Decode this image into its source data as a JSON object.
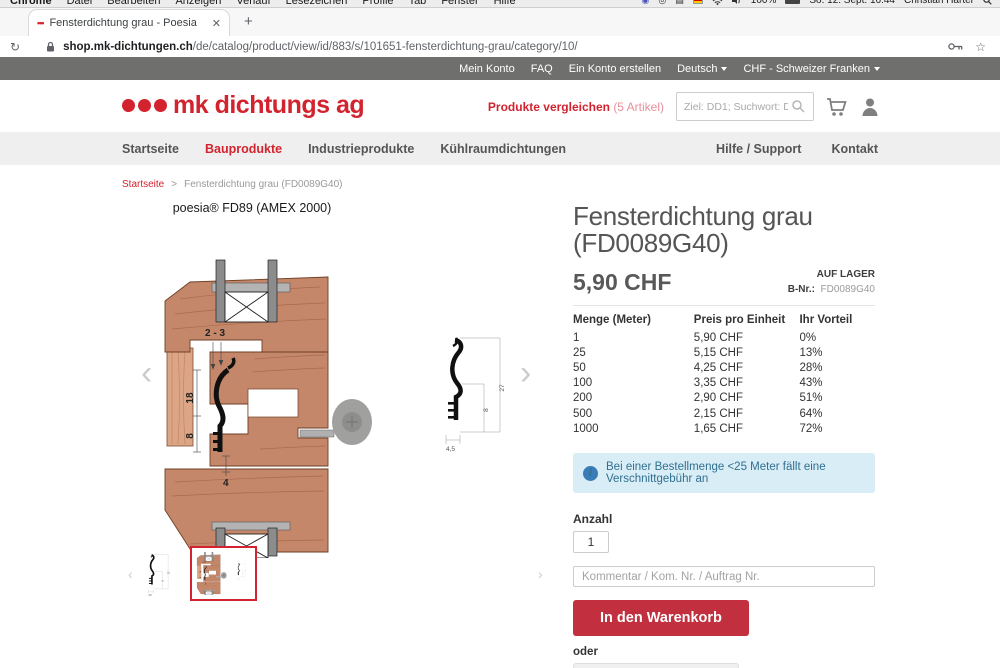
{
  "colors": {
    "brand_red": "#d2232f",
    "button_red": "#c22f3e",
    "topbar_gray": "#6f6f6e",
    "nav_bg": "#f0efef",
    "info_bg": "#d9edf7",
    "info_text": "#31708f",
    "wood": "#c5876a"
  },
  "macos_menubar": {
    "apps": [
      "Chrome",
      "Datei",
      "Bearbeiten",
      "Anzeigen",
      "Verlauf",
      "Lesezeichen",
      "Profile",
      "Tab",
      "Fenster",
      "Hilfe"
    ],
    "battery": "100%",
    "clock": "So. 12. Sept.  16:44",
    "user": "Christian Harter",
    "status_icons": [
      "teams-icon",
      "circle-icon",
      "keyboard-icon",
      "german-flag-icon",
      "wifi-icon",
      "volume-icon",
      "battery-icon",
      "spotlight-search-icon"
    ]
  },
  "browser": {
    "tab_title": "Fensterdichtung grau - Poesia",
    "tab_favicon": "•••",
    "close_glyph": "✕",
    "newtab_glyph": "+",
    "reload_glyph": "↻",
    "star_glyph": "☆",
    "url_domain": "shop.mk-dichtungen.ch",
    "url_path": "/de/catalog/product/view/id/883/s/101651-fensterdichtung-grau/category/10/"
  },
  "topbar": {
    "links": [
      "Mein Konto",
      "FAQ",
      "Ein Konto erstellen"
    ],
    "language": "Deutsch",
    "currency": "CHF - Schweizer Franken"
  },
  "header": {
    "logo_text": "mk dichtungs ag",
    "compare_label": "Produkte vergleichen",
    "compare_count": "(5 Artikel)",
    "search_placeholder": "Ziel: DD1; Suchwort: DD0001"
  },
  "nav": {
    "left": [
      "Startseite",
      "Bauprodukte",
      "Industrieprodukte",
      "Kühlraumdichtungen"
    ],
    "right": [
      "Hilfe / Support",
      "Kontakt"
    ],
    "active": "Bauprodukte"
  },
  "breadcrumb": {
    "home": "Startseite",
    "sep": ">",
    "current": "Fensterdichtung grau (FD0089G40)"
  },
  "gallery": {
    "caption": "poesia® FD89 (AMEX 2000)",
    "dims": {
      "gap": "2 - 3",
      "h1": "18",
      "h2": "8",
      "w": "4",
      "p_h": "27",
      "p_f": "8",
      "p_w": "4,5"
    }
  },
  "product": {
    "title_line1": "Fensterdichtung grau",
    "title_line2": "(FD0089G40)",
    "price": "5,90 CHF",
    "stock": "AUF LAGER",
    "sku_label": "B-Nr.:",
    "sku": "FD0089G40"
  },
  "price_table": {
    "headers": [
      "Menge (Meter)",
      "Preis pro Einheit",
      "Ihr Vorteil"
    ],
    "rows": [
      [
        "1",
        "5,90 CHF",
        "0%"
      ],
      [
        "25",
        "5,15 CHF",
        "13%"
      ],
      [
        "50",
        "4,25 CHF",
        "28%"
      ],
      [
        "100",
        "3,35 CHF",
        "43%"
      ],
      [
        "200",
        "2,90 CHF",
        "51%"
      ],
      [
        "500",
        "2,15 CHF",
        "64%"
      ],
      [
        "1000",
        "1,65 CHF",
        "72%"
      ]
    ]
  },
  "info_note": "Bei einer Bestellmenge <25 Meter fällt eine Verschnittgebühr an",
  "order": {
    "qty_label": "Anzahl",
    "qty_value": "1",
    "comment_placeholder": "Kommentar / Kom. Nr. / Auftrag Nr.",
    "add_to_cart": "In den Warenkorb",
    "or_text": "oder",
    "configure": "Rahmen konfektionieren"
  }
}
